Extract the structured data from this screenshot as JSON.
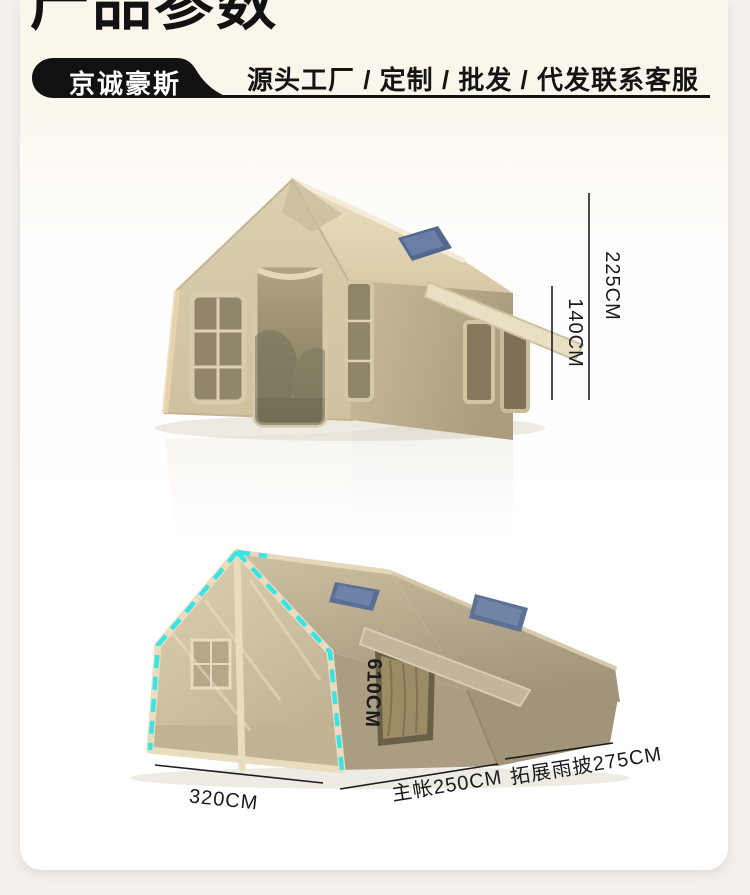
{
  "header": {
    "title": "产品参数",
    "brand": "京诚豪斯",
    "tagline": "源头工厂 / 定制 / 批发 / 代发联系客服"
  },
  "figures": {
    "front_view": {
      "dims": {
        "total_height": "225CM",
        "eave_height": "140CM"
      }
    },
    "side_view": {
      "dims": {
        "ridge_length": "610CM",
        "front_width": "320CM",
        "main_tent": "主帐250CM",
        "extension": "拓展雨披275CM"
      }
    }
  },
  "colors": {
    "page_bg": "#f4f0ee",
    "card_cream": "#fbf6ec",
    "ink": "#141414",
    "tent_khaki": "#d6c9a8",
    "dash_accent": "#38e4e4",
    "skylight_blue": "#5b6f94"
  }
}
